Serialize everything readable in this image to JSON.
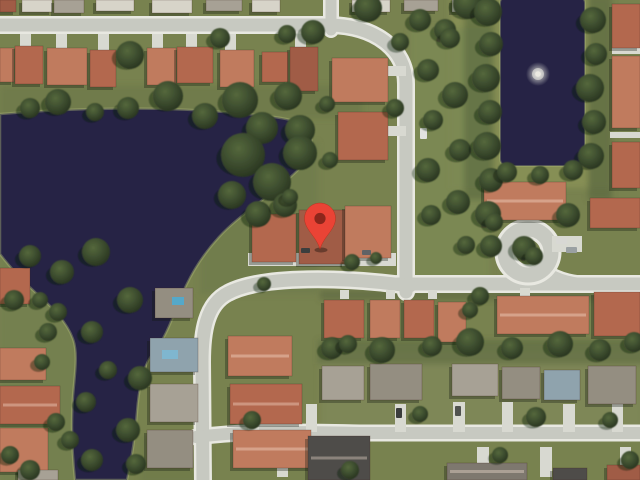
{
  "view": {
    "type": "satellite-map",
    "content": "aerial imagery of lakeside residential neighborhood"
  },
  "marker": {
    "name": "location-marker",
    "color": "#EA4335",
    "outline_color": "#B5321F",
    "inner_color": "#8C261B",
    "position": {
      "x": 320,
      "y": 249
    }
  },
  "features": [
    "lake",
    "pond",
    "fountain",
    "residential-streets",
    "cul-de-sac",
    "houses",
    "condo-buildings",
    "trees",
    "driveways"
  ],
  "palette": {
    "water": "#262345",
    "grass": "#78824f",
    "road": "#c7c9c1",
    "sidewalk": "#e8e8e1",
    "roof_terracotta": "#b3684e",
    "roof_gray": "#948e81",
    "tree": "#3c4c2e",
    "fountain": "#eceae2"
  }
}
